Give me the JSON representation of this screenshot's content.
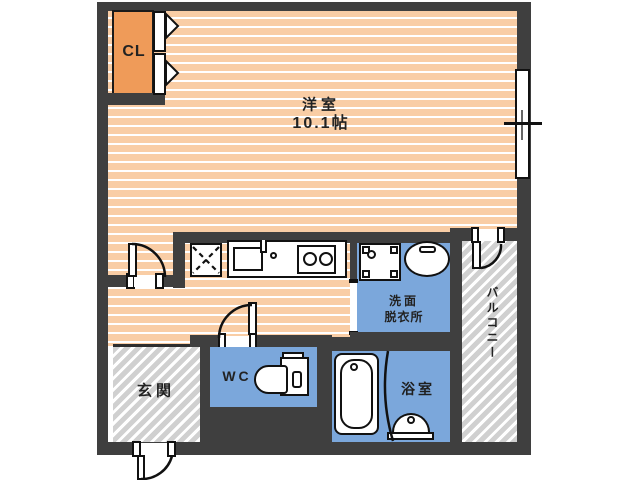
{
  "title": "apartment-floor-plan",
  "rooms": {
    "living": {
      "name": "洋室",
      "area": "10.1帖"
    },
    "closet": {
      "name": "CL"
    },
    "washroom": {
      "name_line1": "洗面",
      "name_line2": "脱衣所"
    },
    "toilet": {
      "name": "WC"
    },
    "bath": {
      "name": "浴室"
    },
    "entrance": {
      "name": "玄関"
    },
    "balcony": {
      "name": "バルコニー"
    }
  },
  "fixtures": [
    "closet-bifold-door-icon",
    "refrigerator-space-icon",
    "kitchen-sink-icon",
    "faucet-icon",
    "stove-2-burner-icon",
    "washing-machine-pan-icon",
    "wash-basin-icon",
    "toilet-icon",
    "bathtub-icon",
    "bath-counter-icon",
    "sliding-window-icon",
    "swing-door-icon"
  ],
  "colors": {
    "wall": "#3f3f3f",
    "floor_orange": "#f9cda5",
    "floor_stripe": "#ffffff",
    "closet_orange": "#ef9b59",
    "wet_area_blue": "#7ba7db",
    "hatch_gray": "#d0d0d0",
    "outline_black": "#111111",
    "text": "#222222"
  }
}
